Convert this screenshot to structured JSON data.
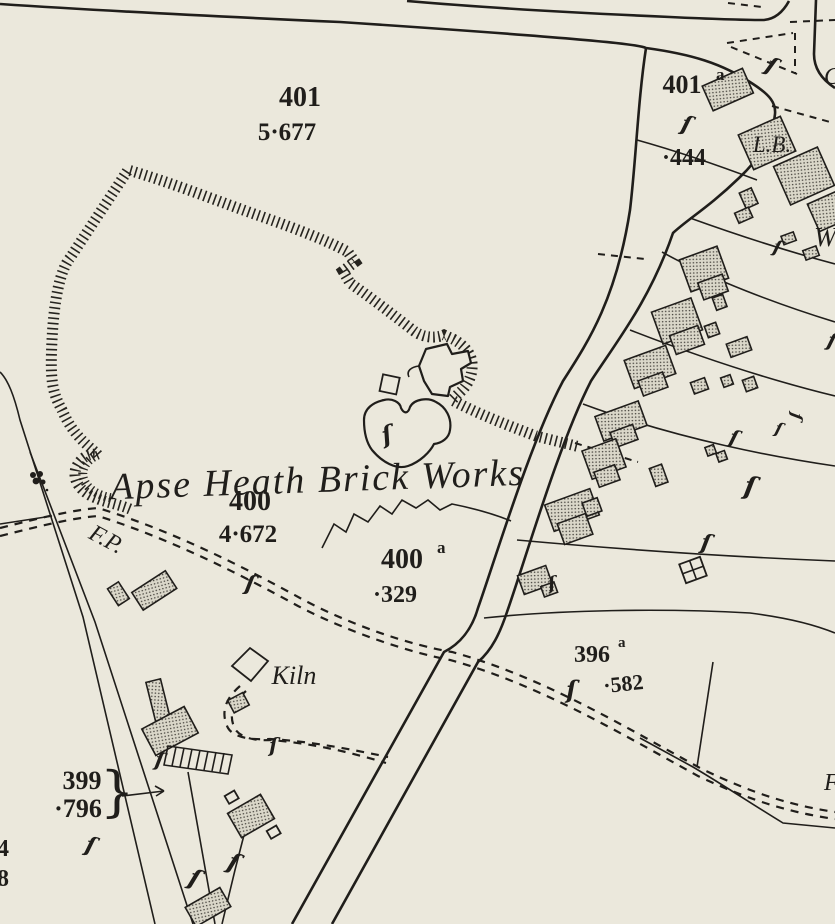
{
  "map": {
    "title": "Ordnance Survey plan — Apse Heath Brick Works",
    "colors": {
      "paper": "#ebe8dc",
      "ink": "#201e1b",
      "stipple_bg": "#dad7c9",
      "stipple_dot": "#45423c"
    },
    "labels": {
      "works_name": {
        "text": "Apse Heath Brick Works"
      },
      "parcel_401": {
        "text": "401"
      },
      "acreage_401": {
        "text": "5·677"
      },
      "parcel_401a": {
        "text": "401",
        "sup": "a"
      },
      "acreage_444": {
        "text": "·444"
      },
      "letter_box": {
        "text": "L.B."
      },
      "parcel_400": {
        "text": "400"
      },
      "acreage_400": {
        "text": "4·672"
      },
      "parcel_400a": {
        "text": "400",
        "sup": "a"
      },
      "acreage_329": {
        "text": "·329"
      },
      "footpath": {
        "text": "F.P."
      },
      "kiln": {
        "text": "Kiln"
      },
      "parcel_396a": {
        "text": "396",
        "sup": "a"
      },
      "acreage_582": {
        "text": "·582"
      },
      "parcel_399": {
        "text": "399"
      },
      "acreage_796": {
        "text": "·796"
      },
      "brace_399": {
        "text": "}"
      },
      "edge_w": {
        "text": "W"
      },
      "edge_c": {
        "text": "C"
      },
      "edge_f": {
        "text": "F"
      },
      "edge_4": {
        "text": "4"
      },
      "edge_8": {
        "text": "8"
      }
    },
    "symbols": {
      "brace_glyph": "ſ"
    }
  }
}
